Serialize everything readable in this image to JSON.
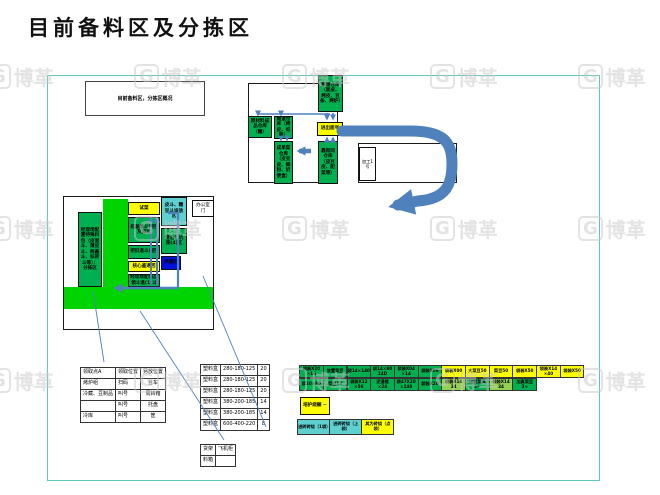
{
  "page": {
    "title": "目前备料区及分拣区"
  },
  "watermark": {
    "logo_char": "G",
    "brand": "博革"
  },
  "colors": {
    "green": "#00b050",
    "yellow": "#ffff00",
    "lightgreen": "#92d050",
    "cyan": "#5fd0d0",
    "blue": "#0010dd",
    "band_green": "#00d400",
    "arrow_blue": "#4f81bd",
    "frame_teal": "#5fc8bd"
  },
  "note_box": {
    "text": "目前备料区，分拣区概况"
  },
  "top_diagram": {
    "storage_main": "整理仓库（面皮、烤皮、豆条、烤炉）",
    "gate": "进出面号",
    "raw_store": "原材料成品仓库（糖）",
    "tunnel_store": "隧道仓库（烤皮、纸箱）",
    "order_store": "成单菜仓库（皮豆皮、细粉、奶便盒）",
    "street_store": "靠街间仓库（皮豆皮、配菜等）",
    "processing_room": "加工1号"
  },
  "left_diagram": {
    "sorting_note": "经现场配置特殊料包（皮面斗、薄皮斗、两酱斗、标砖斗等）：分拣区",
    "mid_boxes": [
      {
        "label": "试菜",
        "color": "yellow"
      },
      {
        "label": "机器退斗退回及异坑",
        "color": "green"
      },
      {
        "label": "把旧退斗退回",
        "color": "green"
      },
      {
        "label": "核心鉴退回",
        "color": "yellow"
      },
      {
        "label": "经现场配商品领斗退(1)斗",
        "color": "green"
      }
    ],
    "right_boxes": [
      {
        "label": "皮斗、糖豆斗垛放区",
        "color": "cyan"
      },
      {
        "label": "浸泡斗坑笼(4)区",
        "color": "green"
      },
      {
        "label": "供暖区",
        "color": "blue"
      }
    ],
    "office_door": "办公室门"
  },
  "tables": {
    "pick": {
      "rows": [
        [
          "领取点A",
          "领取位置",
          "另放位置"
        ],
        [
          "烤炉组",
          "扫码",
          "台车"
        ],
        [
          "冷藏、豆制品",
          "叫号",
          "周转箱"
        ],
        [
          "",
          "叫号",
          "托盘"
        ],
        [
          "冷库",
          "叫号",
          "筐"
        ]
      ]
    },
    "box_sizes": {
      "rows": [
        [
          "塑料盒",
          "280-180-125",
          "20"
        ],
        [
          "塑料盒",
          "280-180-125",
          "20"
        ],
        [
          "塑料盒",
          "280-180-125",
          "20"
        ],
        [
          "塑料盒",
          "380-200-185",
          "14"
        ],
        [
          "塑料盒",
          "380-200-185",
          "14"
        ],
        [
          "塑料盒",
          "600-400-220",
          "8"
        ]
      ]
    },
    "rack": {
      "rows": [
        [
          "货架",
          "飞机柜"
        ],
        [
          "料箱",
          ""
        ]
      ]
    }
  },
  "strip": {
    "row1": [
      {
        "label": "袋装X20 ×16",
        "color": "green"
      },
      {
        "label": "放置菜豆",
        "color": "green"
      },
      {
        "label": "袋14×140",
        "color": "green"
      },
      {
        "label": "袋14×80 14D",
        "color": "green"
      },
      {
        "label": "袋装X04 ×14",
        "color": "green"
      },
      {
        "label": "袋装X06",
        "color": "green"
      },
      {
        "label": "袋装X00",
        "color": "yellow"
      },
      {
        "label": "大菜豆50",
        "color": "yellow"
      },
      {
        "label": "菜豆50",
        "color": "yellow"
      },
      {
        "label": "袋装X50",
        "color": "yellow"
      },
      {
        "label": "袋装X14 ×40",
        "color": "yellow"
      },
      {
        "label": "袋装X50",
        "color": "yellow"
      }
    ],
    "row2": [
      {
        "label": "袋20×80",
        "color": "green"
      },
      {
        "label": "菜豆12",
        "color": "green"
      },
      {
        "label": "袋装X12 ×56",
        "color": "green"
      },
      {
        "label": "泥漫楼 ×24",
        "color": "green"
      },
      {
        "label": "袋47X20 ×140",
        "color": "green"
      },
      {
        "label": "袋装X20",
        "color": "green"
      },
      {
        "label": "袋装X14 34",
        "color": "lightgreen"
      },
      {
        "label": "放置菜具 3+",
        "color": "green"
      },
      {
        "label": "袋装X14 34",
        "color": "lightgreen"
      },
      {
        "label": "加真菜豆 3+",
        "color": "green"
      }
    ]
  },
  "extra": {
    "single_box": {
      "label": "培护绕橱 ~",
      "color": "yellow"
    },
    "bottom_boxes": [
      {
        "label": "进砖砖绕（1袋）",
        "color": "cyan"
      },
      {
        "label": "进砖砖绕（上袋）",
        "color": "cyan"
      },
      {
        "label": "其为砖绕（点袋）",
        "color": "yellow"
      }
    ]
  }
}
